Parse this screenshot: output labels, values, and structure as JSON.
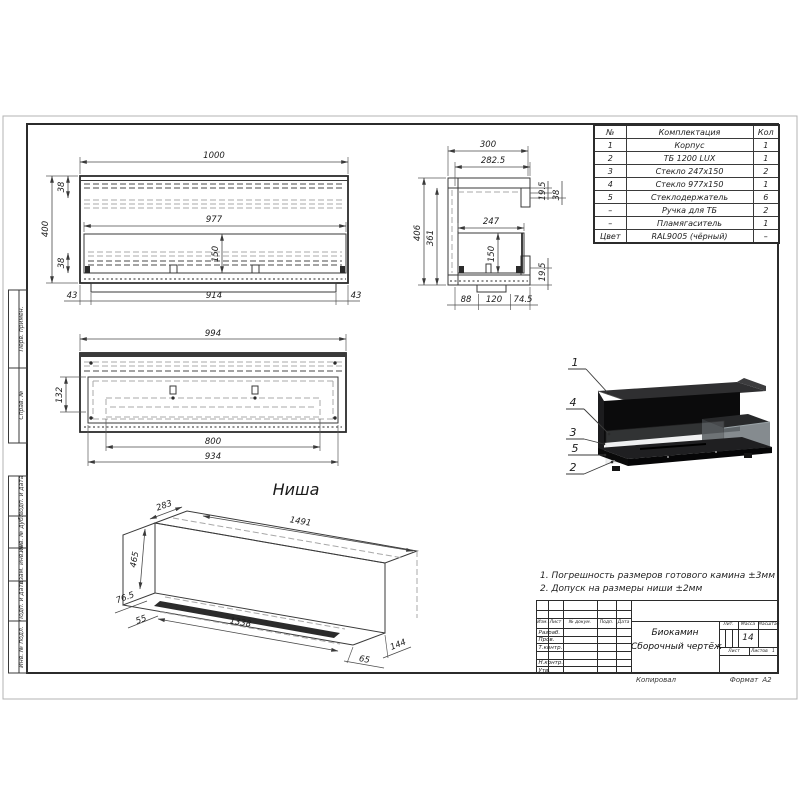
{
  "colors": {
    "paper": "#ffffff",
    "ink": "#2b2b2b",
    "hidden_line": "#a8a8a8",
    "render_body": "#111214",
    "glass": "#9aa3a7"
  },
  "sheet": {
    "copied_label": "Копировал",
    "format_label": "Формат",
    "format_value": "А2"
  },
  "margin_stamps": [
    "Перв. примен.",
    "Справ. №",
    "Подп. и дата",
    "Инв. № дубл.",
    "Взам. инв. №",
    "Подп. и дата",
    "Инв. № подл."
  ],
  "parts_table": {
    "headers": {
      "num": "№",
      "name": "Комплектация",
      "qty": "Кол"
    },
    "rows": [
      {
        "num": "1",
        "name": "Корпус",
        "qty": "1"
      },
      {
        "num": "2",
        "name": "ТБ 1200 LUX",
        "qty": "1"
      },
      {
        "num": "3",
        "name": "Стекло 247х150",
        "qty": "2"
      },
      {
        "num": "4",
        "name": "Стекло 977х150",
        "qty": "1"
      },
      {
        "num": "5",
        "name": "Стеклодержатель",
        "qty": "6"
      },
      {
        "num": "–",
        "name": "Ручка для ТБ",
        "qty": "2"
      },
      {
        "num": "–",
        "name": "Пламягаситель",
        "qty": "1"
      },
      {
        "num": "Цвет",
        "name": "RAL9005 (чёрный)",
        "qty": "–"
      }
    ]
  },
  "notes": {
    "line1": "1. Погрешность размеров готового камина ±3мм",
    "line2": "2. Допуск на размеры ниши ±2мм"
  },
  "views": {
    "front": {
      "dim_width": "1000",
      "dim_height": "400",
      "dim_top": "38",
      "dim_inner_width": "977",
      "dim_glass_height": "150",
      "dim_bottom": "38",
      "dim_left_gap": "43",
      "dim_base": "914",
      "dim_right_gap": "43"
    },
    "side": {
      "dim_width": "300",
      "dim_inner_width": "282.5",
      "dim_lip_top": "19.5",
      "dim_flange": "38",
      "dim_height": "406",
      "dim_inner_height": "361",
      "dim_glass_width": "247",
      "dim_glass_height": "150",
      "dim_lip_bottom": "19.5",
      "dim_seg1": "88",
      "dim_seg2": "120",
      "dim_seg3": "74.5"
    },
    "plan": {
      "dim_width": "994",
      "dim_depth": "132",
      "dim_burner": "800",
      "dim_inner": "934"
    },
    "niche": {
      "label": "Ниша",
      "dim_depth": "283",
      "dim_length": "1491",
      "dim_height": "465",
      "dim_a": "76.5",
      "dim_b": "55",
      "dim_inner": "1338",
      "dim_c": "65",
      "dim_d": "144"
    }
  },
  "render_callouts": [
    "1",
    "4",
    "3",
    "5",
    "2"
  ],
  "title_block": {
    "doc_title_line1": "Биокамин",
    "doc_title_line2": "Сборочный чертёж",
    "cols": {
      "izm": "Изм.",
      "list": "Лист",
      "doc": "№ докум.",
      "podp": "Подп.",
      "data": "Дата"
    },
    "rows": {
      "r0": "Разраб.",
      "r1": "Пров.",
      "r2": "Т.контр.",
      "r3": "Н.контр.",
      "r4": "Утв."
    },
    "lit_label": "Лит.",
    "mass_label": "Масса",
    "scale_label": "Масштаб",
    "mass_value": "14",
    "list_label": "Лист",
    "listov_label": "Листов",
    "listov_value": "1"
  }
}
